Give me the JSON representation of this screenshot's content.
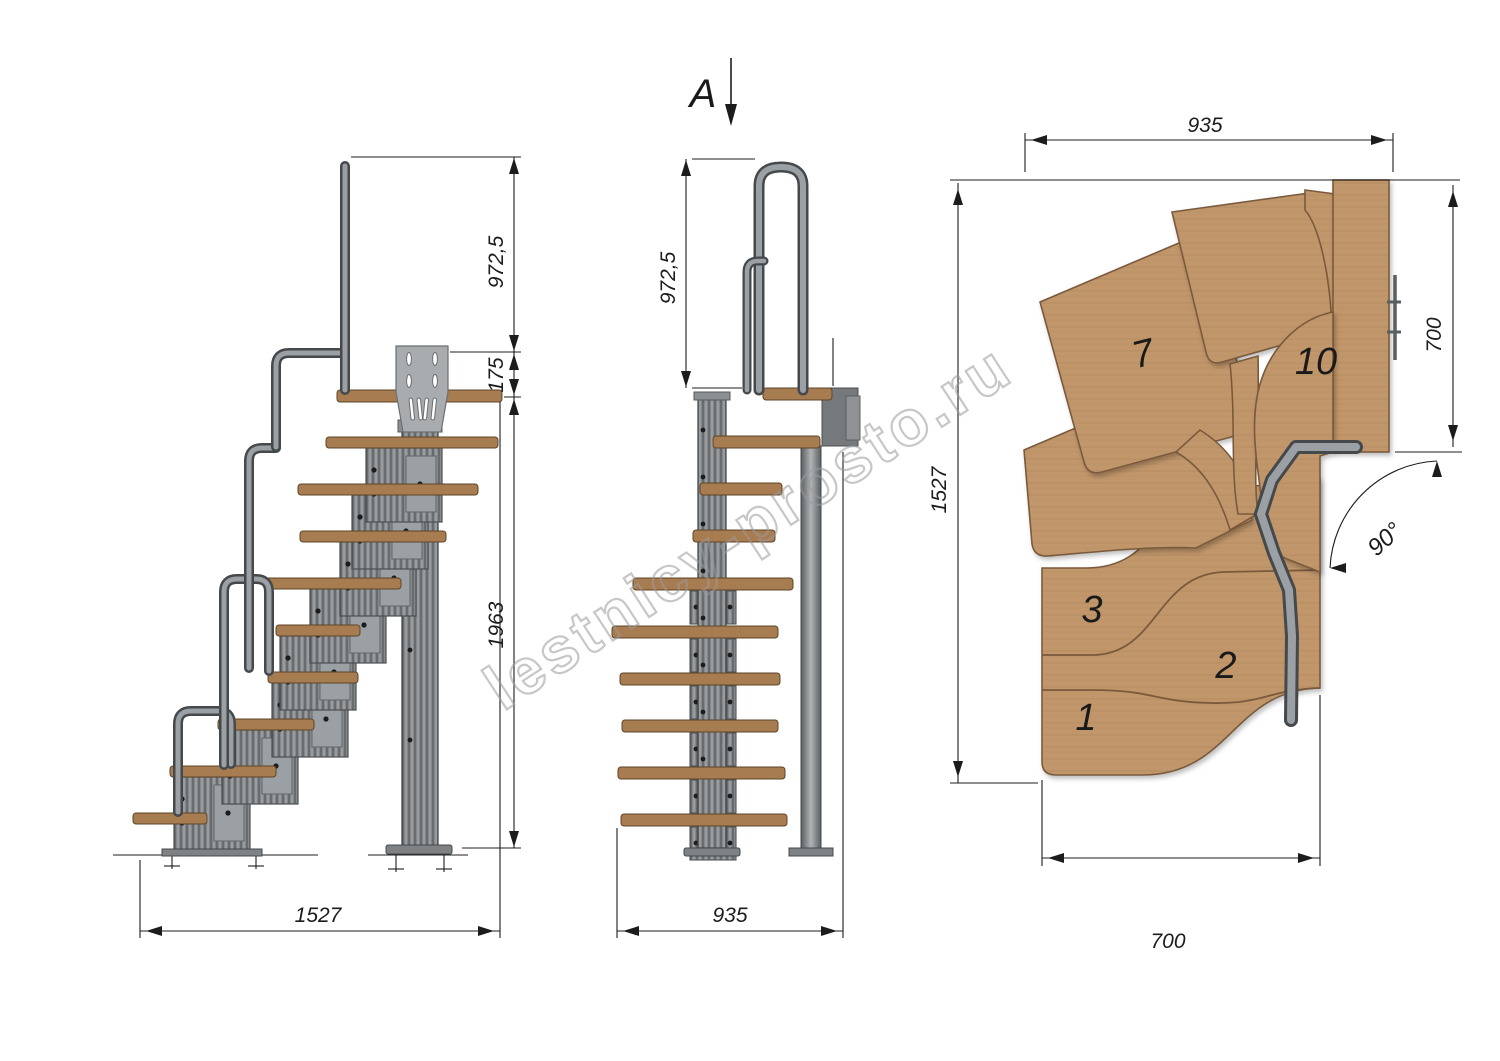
{
  "watermark": {
    "text": "lestnicy-prosto.ru"
  },
  "section_marker": {
    "label": "A"
  },
  "side_view": {
    "dim_rail_height": "972,5",
    "dim_plate_drop": "175",
    "dim_column_height": "1963",
    "dim_total_run": "1527"
  },
  "front_view": {
    "dim_rail_height": "972,5",
    "dim_total_width": "935"
  },
  "plan_view": {
    "dim_top_width": "935",
    "dim_landing_depth": "700",
    "dim_total_length": "1527",
    "dim_bottom_width": "700",
    "dim_turn_angle": "90°",
    "step_labels": {
      "s1": "1",
      "s2": "2",
      "s3": "3",
      "s7": "7",
      "s10": "10"
    }
  },
  "colors": {
    "wood_plan": "#c1966b",
    "wood_grain": "#ab825a",
    "wood_side": "#a87c51",
    "steel_dark": "#45494c",
    "steel_mid": "#84888b",
    "steel_light": "#9ba0a4",
    "line": "#1c1c1c",
    "watermark": "#9a9a9a"
  }
}
